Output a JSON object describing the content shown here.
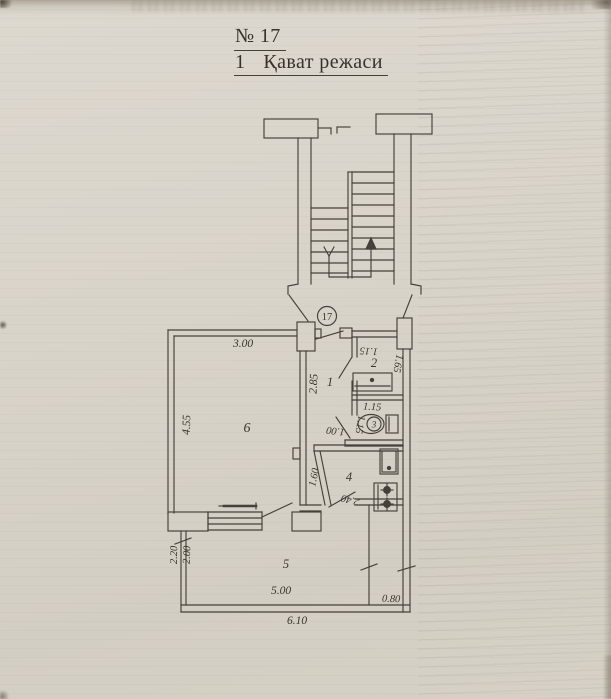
{
  "title": {
    "number": "№ 17",
    "line2_prefix": "1",
    "line2_text": "Қават режаси"
  },
  "plan": {
    "unit_number": "17",
    "room_numbers": {
      "hall": "1",
      "bathroom": "2",
      "wc": "3",
      "kitchen": "4",
      "loggia": "5",
      "living": "6"
    },
    "dimensions": {
      "living_width": "3.00",
      "living_depth": "4.55",
      "hall_depth": "2.85",
      "bath_width": "1.15",
      "bath_depth": "1.65",
      "wc_width": "1.15",
      "wc_depth": "1.15",
      "wc_lobby": "1.00",
      "kitchen_wall": "1.60",
      "kitchen_depth": "2.40",
      "loggia_depth_outer": "2.20",
      "loggia_depth_inner": "2.00",
      "loggia_width": "5.00",
      "strip_width": "0.80",
      "total_width": "6.10"
    },
    "ink_color": "#44403a",
    "paper_color": "#d8d3c9"
  }
}
